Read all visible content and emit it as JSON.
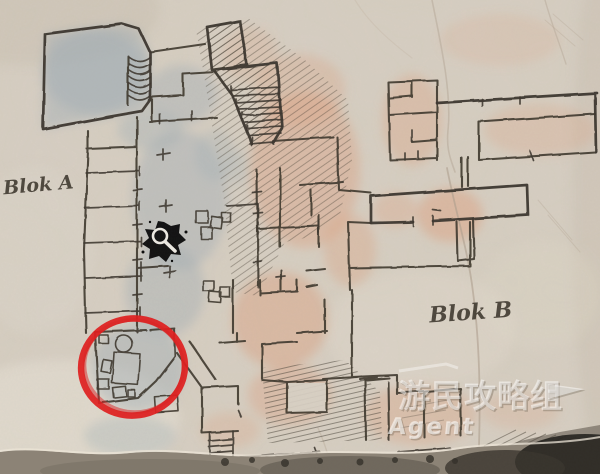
{
  "map": {
    "labels": {
      "block_a": "Blok A",
      "block_b": "Blok B"
    },
    "icons": {
      "poi_marker": "magnifier-splat-icon"
    },
    "annotation": {
      "shape": "hand-drawn-circle",
      "color": "#e01e1e"
    },
    "colors": {
      "paper": "#d7cfc3",
      "ink": "#3d372f",
      "wash_cool": "#9dabb4",
      "wash_warm": "#dd9c78",
      "torn_edge_dark": "#2b2823"
    }
  },
  "watermark": {
    "brand": "游民攻略组",
    "tagline": "Agent",
    "flag_icon": "flag-arrow-icon",
    "color": "#ffffff"
  }
}
